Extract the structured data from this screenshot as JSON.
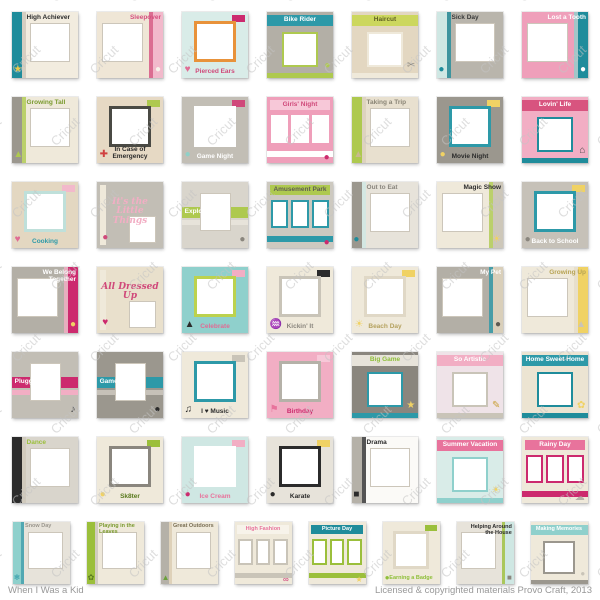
{
  "watermark": {
    "text": "Cricut",
    "color": "#c4c4c4"
  },
  "footer": {
    "left": "When I Was a Kid",
    "right": "Licensed & copyrighted materials Provo Craft, 2013"
  },
  "colors": {
    "teal": "#1f8c9b",
    "light_teal": "#8fd0cc",
    "mint": "#cfe7e3",
    "green": "#9bbf3b",
    "magenta": "#cc2a6e",
    "pink": "#f2aec4",
    "cream": "#efe9da",
    "tan": "#e3d7c1",
    "gray": "#b3afa6",
    "yellow": "#f0d264"
  },
  "grid": {
    "rows": [
      [
        {
          "t": "High Achiever",
          "v": "band",
          "bg": "#f2ecdf",
          "a": "#1f8c9b",
          "b": "#cdc7b9",
          "tc": "#2b2b2b",
          "ic": "★",
          "icc": "#e9c94d"
        },
        {
          "t": "Sleepover",
          "v": "bandr",
          "bg": "#efe6d6",
          "a": "#f2b9cb",
          "b": "#d64f7f",
          "tc": "#d64f7f",
          "ic": "●",
          "icc": "#f7f3ea"
        },
        {
          "t": "Pierced Ears",
          "v": "frame",
          "bg": "#d9ece8",
          "a": "#e8923a",
          "b": "#cc2a6e",
          "tc": "#d0497a",
          "ic": "♥",
          "icc": "#e06c94"
        },
        {
          "t": "Bike Rider",
          "v": "top",
          "bg": "#b3afa6",
          "a": "#2d99a8",
          "b": "#aec94f",
          "tc": "#ffffff",
          "ic": "●",
          "icc": "#aec94f"
        },
        {
          "t": "Haircut",
          "v": "top",
          "bg": "#e3d7c1",
          "a": "#ccd75e",
          "b": "#efe9da",
          "tc": "#5f5f23",
          "ic": "✂",
          "icc": "#8a867e"
        },
        {
          "t": "Sick Day",
          "v": "band",
          "bg": "#b9b5ac",
          "a": "#cfe7e3",
          "b": "#1f8c9b",
          "tc": "#3a3a3a",
          "ic": "●",
          "icc": "#1f8c9b"
        },
        {
          "t": "Lost a Tooth",
          "v": "bandr",
          "bg": "#ef9fba",
          "a": "#1f8c9b",
          "b": "#8fd0cc",
          "tc": "#ffffff",
          "ic": "●",
          "icc": "#ffffff"
        }
      ],
      [
        {
          "t": "Growing Tall",
          "v": "band",
          "bg": "#efe9da",
          "a": "#9b978e",
          "b": "#aec94f",
          "tc": "#7a9a2e",
          "ic": "▲",
          "icc": "#aec94f"
        },
        {
          "t": "In Case of Emergency",
          "v": "frame",
          "bg": "#e6d9c4",
          "a": "#4a4a44",
          "b": "#aec94f",
          "tc": "#2b2b2b",
          "ic": "✚",
          "icc": "#d04040"
        },
        {
          "t": "Game Night",
          "v": "frame",
          "bg": "#c2beb5",
          "a": "#ffffff",
          "b": "#d0497a",
          "tc": "#ffffff",
          "ic": "●",
          "icc": "#8fd0c8"
        },
        {
          "t": "Girls' Night",
          "v": "grid",
          "bg": "#ef9fba",
          "a": "#f7c8d8",
          "b": "#ffffff",
          "tc": "#d0497a",
          "ic": "●",
          "icc": "#cc2a6e"
        },
        {
          "t": "Taking a Trip",
          "v": "band",
          "bg": "#e8e0cf",
          "a": "#aec94f",
          "b": "#d9cfba",
          "tc": "#8a8576",
          "ic": "▲",
          "icc": "#c8b98e"
        },
        {
          "t": "Movie Night",
          "v": "frame",
          "bg": "#9b978e",
          "a": "#2d99a8",
          "b": "#f0d264",
          "tc": "#2b2b2b",
          "ic": "●",
          "icc": "#f0d264"
        },
        {
          "t": "Lovin' Life",
          "v": "top",
          "bg": "#f2aec4",
          "a": "#d8547f",
          "b": "#1f8c9b",
          "tc": "#ffffff",
          "ic": "⌂",
          "icc": "#4a4a4a"
        }
      ],
      [
        {
          "t": "Cooking",
          "v": "frame",
          "bg": "#e3d7c1",
          "a": "#bfe0da",
          "b": "#f2b9cb",
          "tc": "#2d99a8",
          "ic": "♥",
          "icc": "#e06c94"
        },
        {
          "t": "It's the Little Things",
          "v": "script",
          "bg": "#c2beb5",
          "a": "#efe9da",
          "b": "",
          "tc": "#f2aec4",
          "ic": "●",
          "icc": "#d0497a"
        },
        {
          "t": "Exploring",
          "v": "stripes",
          "bg": "#d9d5cc",
          "a": "#aec94f",
          "b": "#e7e3da",
          "tc": "#ffffff",
          "ic": "●",
          "icc": "#8a867e"
        },
        {
          "t": "Amusement Park",
          "v": "grid",
          "bg": "#cdc9c0",
          "a": "#aec94f",
          "b": "#2d99a8",
          "tc": "#5f5b52",
          "ic": "●",
          "icc": "#cc2a6e"
        },
        {
          "t": "Out to Eat",
          "v": "band",
          "bg": "#e7e3da",
          "a": "#9b978e",
          "b": "#cfe7e3",
          "tc": "#8a867e",
          "ic": "●",
          "icc": "#1f8c9b"
        },
        {
          "t": "Magic Show",
          "v": "bandr",
          "bg": "#efe9da",
          "a": "#cdc7b9",
          "b": "#aec94f",
          "tc": "#2b2b2b",
          "ic": "☀",
          "icc": "#f0d264"
        },
        {
          "t": "Back to School",
          "v": "frame",
          "bg": "#c6c1b8",
          "a": "#2d99a8",
          "b": "#f0d264",
          "tc": "#ffffff",
          "ic": "●",
          "icc": "#8a867e"
        }
      ],
      [
        {
          "t": "We Belong Together",
          "v": "bandr",
          "bg": "#b3afa6",
          "a": "#cc2a6e",
          "b": "#f2aec4",
          "tc": "#ffffff",
          "ic": "●",
          "icc": "#f0d264"
        },
        {
          "t": "All Dressed Up",
          "v": "script",
          "bg": "#e9e0cc",
          "a": "#efe9da",
          "b": "",
          "tc": "#d0497a",
          "ic": "♥",
          "icc": "#cc2a6e"
        },
        {
          "t": "Celebrate",
          "v": "frame",
          "bg": "#8fd0cc",
          "a": "#bcd24e",
          "b": "#f2aec4",
          "tc": "#e06c94",
          "ic": "▲",
          "icc": "#2b2b2b"
        },
        {
          "t": "Kickin' It",
          "v": "frame",
          "bg": "#efe9da",
          "a": "#c9c4b8",
          "b": "#2b2b2b",
          "tc": "#8a867e",
          "ic": "♒",
          "icc": "#2b2b2b"
        },
        {
          "t": "Beach Day",
          "v": "frame",
          "bg": "#efe9da",
          "a": "#e0d8c6",
          "b": "#f0d264",
          "tc": "#b5a25f",
          "ic": "☀",
          "icc": "#f0d264"
        },
        {
          "t": "My Pet",
          "v": "bandr",
          "bg": "#b3afa6",
          "a": "#d9cfba",
          "b": "#2d99a8",
          "tc": "#ffffff",
          "ic": "●",
          "icc": "#5f5b52"
        },
        {
          "t": "Growing Up",
          "v": "bandr",
          "bg": "#efe9da",
          "a": "#f0d264",
          "b": "#e5dcc8",
          "tc": "#b7a353",
          "ic": "▲",
          "icc": "#c9c4b8"
        }
      ],
      [
        {
          "t": "Plugged In",
          "v": "stripes",
          "bg": "#c2beb5",
          "a": "#cc2a6e",
          "b": "#f2aec4",
          "tc": "#ffffff",
          "ic": "♪",
          "icc": "#2b2b2b"
        },
        {
          "t": "Game On",
          "v": "stripes",
          "bg": "#9b978e",
          "a": "#2d99a8",
          "b": "#c6c1b8",
          "tc": "#ffffff",
          "ic": "●",
          "icc": "#2b2b2b"
        },
        {
          "t": "I ♥ Music",
          "v": "frame",
          "bg": "#efe9da",
          "a": "#2d99a8",
          "b": "#c9c4b8",
          "tc": "#2b2b2b",
          "ic": "♫",
          "icc": "#2b2b2b"
        },
        {
          "t": "Birthday",
          "v": "frame",
          "bg": "#f2aec4",
          "a": "#b5b1a8",
          "b": "#f7c8d8",
          "tc": "#cc2a6e",
          "ic": "⚑",
          "icc": "#e8739c"
        },
        {
          "t": "Big Game",
          "v": "top",
          "bg": "#8a867e",
          "a": "#e7e3da",
          "b": "#2d99a8",
          "tc": "#8fbf3a",
          "ic": "★",
          "icc": "#f0d264"
        },
        {
          "t": "So Artistic",
          "v": "top",
          "bg": "#efe3e8",
          "a": "#f2aec4",
          "b": "#c9c4b8",
          "tc": "#ffffff",
          "ic": "✎",
          "icc": "#c9a23a"
        },
        {
          "t": "Home Sweet Home",
          "v": "top",
          "bg": "#ece4d2",
          "a": "#2d99a8",
          "b": "#1f8c9b",
          "tc": "#ffffff",
          "ic": "✿",
          "icc": "#f0d264"
        }
      ],
      [
        {
          "t": "Dance",
          "v": "band",
          "bg": "#d9d5cc",
          "a": "#2b2b2b",
          "b": "#cdc7b9",
          "tc": "#9bbf3b",
          "ic": "◆",
          "icc": "#2b2b2b"
        },
        {
          "t": "Sk8ter",
          "v": "frame",
          "bg": "#efe9da",
          "a": "#8a867e",
          "b": "#9bbf3b",
          "tc": "#5a7a1e",
          "ic": "●",
          "icc": "#f0d264"
        },
        {
          "t": "Ice Cream",
          "v": "frame",
          "bg": "#cfe7e3",
          "a": "#ffffff",
          "b": "#f2aec4",
          "tc": "#e8739c",
          "ic": "●",
          "icc": "#cc2a6e"
        },
        {
          "t": "Karate",
          "v": "frame",
          "bg": "#e7e3da",
          "a": "#2b2b2b",
          "b": "#f0d264",
          "tc": "#2b2b2b",
          "ic": "●",
          "icc": "#2b2b2b"
        },
        {
          "t": "Drama",
          "v": "band",
          "bg": "#fbfaf7",
          "a": "#b5b1a8",
          "b": "#2b2b2b",
          "tc": "#2b2b2b",
          "ic": "■",
          "icc": "#2b2b2b"
        },
        {
          "t": "Summer Vacation",
          "v": "top",
          "bg": "#d9ece8",
          "a": "#e8739c",
          "b": "#8fd0cc",
          "tc": "#ffffff",
          "ic": "☀",
          "icc": "#f0d264"
        },
        {
          "t": "Rainy Day",
          "v": "grid",
          "bg": "#efe9da",
          "a": "#e8739c",
          "b": "#cc2a6e",
          "tc": "#ffffff",
          "ic": "☁",
          "icc": "#b5b1a8"
        }
      ],
      [
        {
          "t": "Snow Day",
          "v": "band",
          "bg": "#e7e3da",
          "a": "#8fd0cc",
          "b": "#2d99a8",
          "tc": "#9b978e",
          "ic": "❄",
          "icc": "#2d99a8"
        },
        {
          "t": "Playing in the Leaves",
          "v": "band",
          "bg": "#efe9da",
          "a": "#9bbf3b",
          "b": "#c9c4b8",
          "tc": "#7a9a2e",
          "ic": "✿",
          "icc": "#5a7a1e"
        },
        {
          "t": "Great Outdoors",
          "v": "band",
          "bg": "#efe9da",
          "a": "#b5b1a8",
          "b": "#d9cbb0",
          "tc": "#7a6f55",
          "ic": "▲",
          "icc": "#6aa03a"
        },
        {
          "t": "High Fashion",
          "v": "grid",
          "bg": "#efe9da",
          "a": "#f7f3ea",
          "b": "#c9c4b8",
          "tc": "#e8739c",
          "ic": "∞",
          "icc": "#cc2a6e"
        },
        {
          "t": "Picture Day",
          "v": "grid",
          "bg": "#efe9da",
          "a": "#1f8c9b",
          "b": "#9bbf3b",
          "tc": "#ffffff",
          "ic": "★",
          "icc": "#f0d264"
        },
        {
          "t": "Earning a Badge",
          "v": "frame",
          "bg": "#efe9da",
          "a": "#e0d8c6",
          "b": "#9bbf3b",
          "tc": "#8fbf3a",
          "ic": "●",
          "icc": "#8fbf3a"
        },
        {
          "t": "Helping Around the House",
          "v": "bandr",
          "bg": "#e7e3da",
          "a": "#cfe7e3",
          "b": "#9bbf3b",
          "tc": "#2b2b2b",
          "ic": "■",
          "icc": "#8a867e"
        },
        {
          "t": "Making Memories",
          "v": "top",
          "bg": "#efe9da",
          "a": "#8fd0cc",
          "b": "#9b978e",
          "tc": "#ffffff",
          "ic": "●",
          "icc": "#c9c4b8"
        }
      ]
    ]
  }
}
